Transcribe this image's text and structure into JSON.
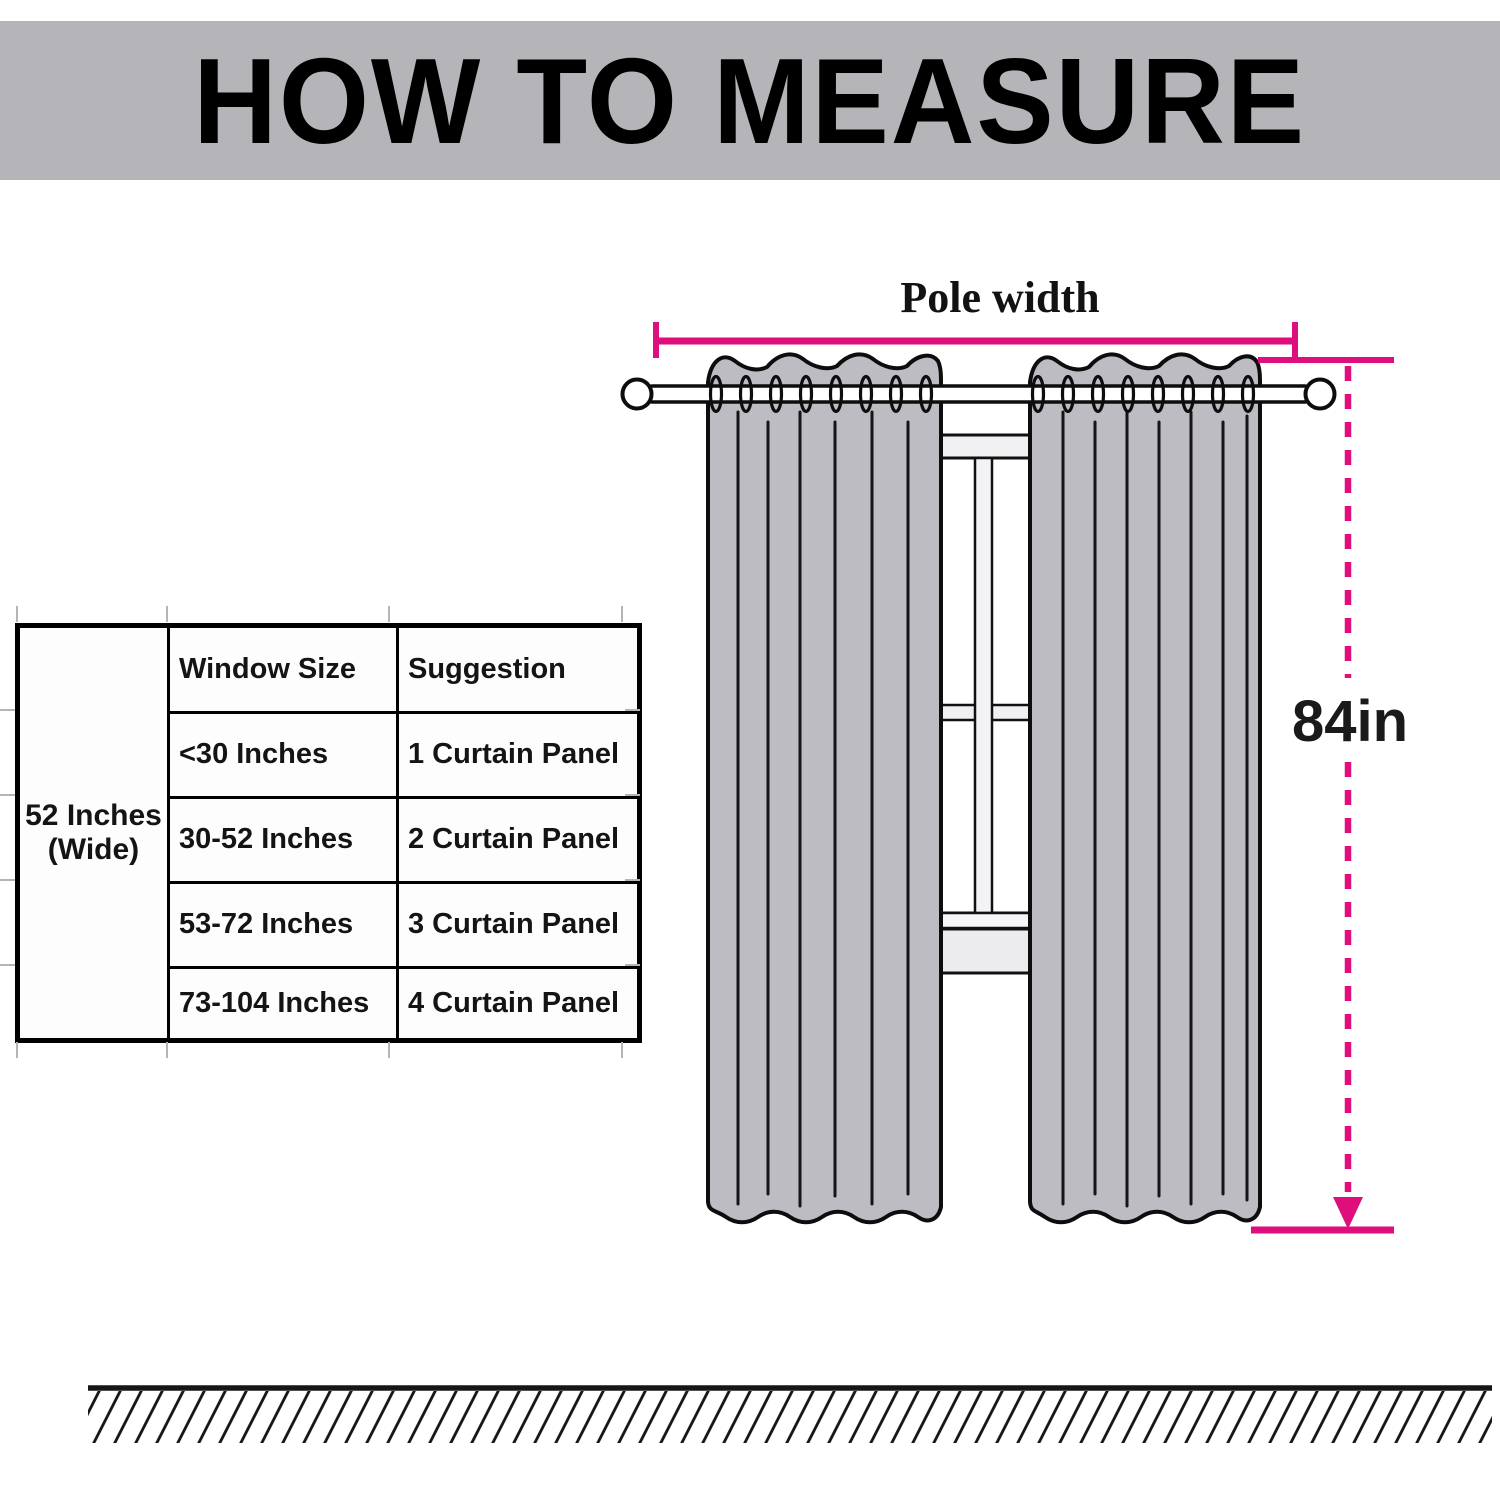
{
  "header": {
    "title": "HOW TO MEASURE"
  },
  "size_table": {
    "width_label": "52 Inches\n(Wide)",
    "headers": [
      "Window Size",
      "Suggestion"
    ],
    "rows": [
      {
        "window_size": "<30 Inches",
        "suggestion": "1 Curtain Panel"
      },
      {
        "window_size": "30-52 Inches",
        "suggestion": "2 Curtain Panel"
      },
      {
        "window_size": "53-72 Inches",
        "suggestion": "3 Curtain Panel"
      },
      {
        "window_size": "73-104 Inches",
        "suggestion": "4 Curtain Panel"
      }
    ]
  },
  "diagram": {
    "pole_width_label": "Pole width",
    "height_label": "84in"
  },
  "colors": {
    "accent_pink": "#de0e7d",
    "curtain_gray": "#bcbcc2",
    "banner_gray": "#b4b4b9",
    "window_frame_gray": "#efeff1",
    "outline_black": "#111111"
  }
}
